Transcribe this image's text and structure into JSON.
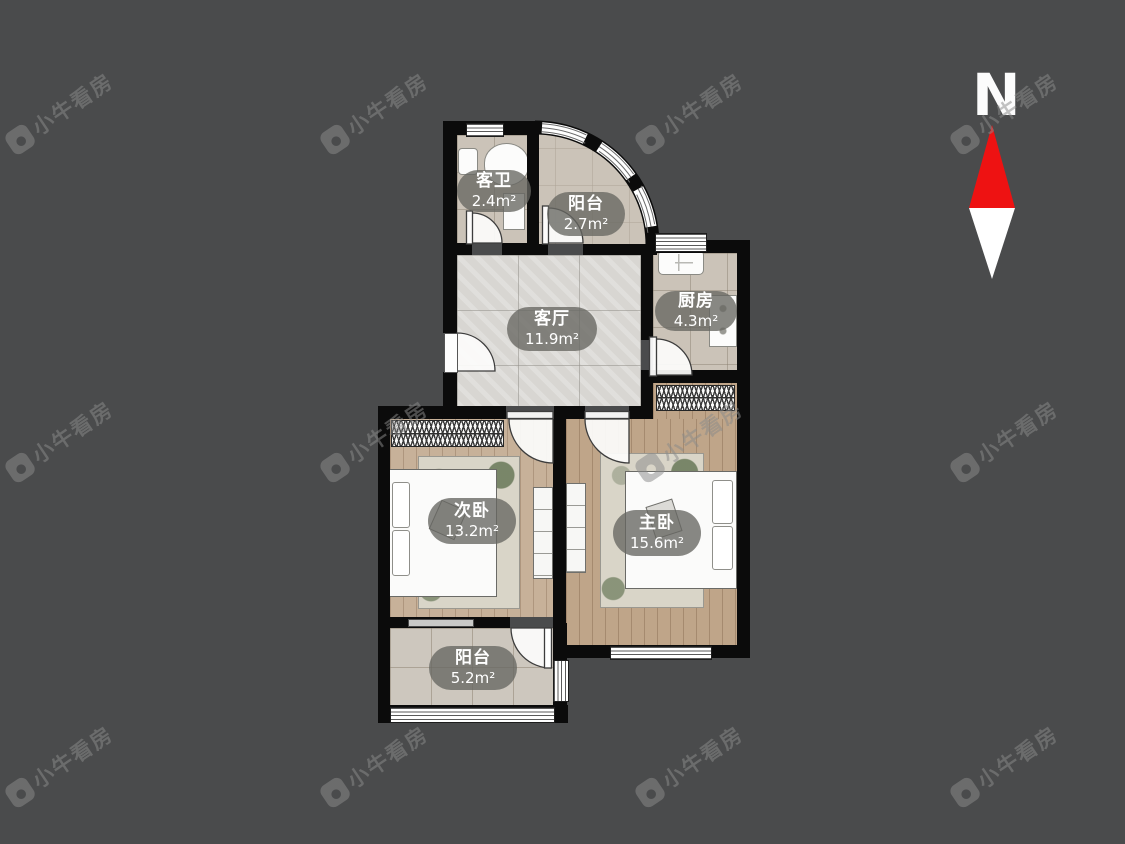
{
  "watermark": {
    "text": "小牛看房"
  },
  "compass": {
    "label": "N"
  },
  "rooms": [
    {
      "id": "guest-bathroom",
      "name": "客卫",
      "area": "2.4m²"
    },
    {
      "id": "balcony-top",
      "name": "阳台",
      "area": "2.7m²"
    },
    {
      "id": "living-room",
      "name": "客厅",
      "area": "11.9m²"
    },
    {
      "id": "kitchen",
      "name": "厨房",
      "area": "4.3m²"
    },
    {
      "id": "secondary-bedroom",
      "name": "次卧",
      "area": "13.2m²"
    },
    {
      "id": "master-bedroom",
      "name": "主卧",
      "area": "15.6m²"
    },
    {
      "id": "balcony-bottom",
      "name": "阳台",
      "area": "5.2m²"
    }
  ],
  "colors": {
    "background": "#4a4b4c",
    "wall": "#0b0b0b",
    "compass_north_red": "#ee1212",
    "label_pill": "rgba(103,103,97,0.78)"
  }
}
